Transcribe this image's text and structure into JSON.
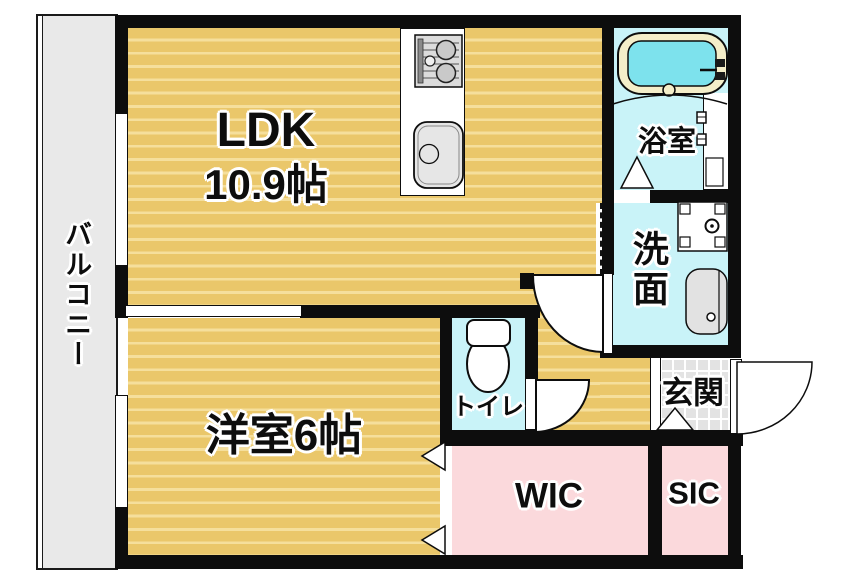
{
  "plan_type": "apartment-floorplan",
  "rooms": {
    "balcony": {
      "label": "バルコニー"
    },
    "ldk": {
      "label": "LDK",
      "area": "10.9帖"
    },
    "western_room": {
      "label": "洋室6帖"
    },
    "bathroom": {
      "label": "浴室"
    },
    "washroom": {
      "label": "洗面"
    },
    "toilet": {
      "label": "トイレ"
    },
    "entrance": {
      "label": "玄関"
    },
    "wic": {
      "label": "WIC"
    },
    "sic": {
      "label": "SIC"
    }
  },
  "colors": {
    "wall": "#0d0d0d",
    "flooring": "#eac76a",
    "flooring_stripe": "#f5df9c",
    "wet_room_floor": "#c9f3f8",
    "closet_pink": "#fbd9dc",
    "balcony_gray": "#e9e9e9",
    "entrance_tile": "#e3e3e3",
    "bathtub_water": "#7de2ed",
    "bathtub_rim": "#f4eec9"
  },
  "icons": {
    "bathtub": "bathtub-icon",
    "gas_stove": "gas-stove-icon",
    "kitchen_sink": "kitchen-sink-icon",
    "washing_machine_pan": "washing-machine-pan-icon",
    "vanity_basin": "vanity-basin-icon",
    "toilet_bowl": "toilet-bowl-icon",
    "door_swing": "door-swing-arc",
    "folding_door": "folding-door-triangle",
    "sliding_window": "window-strip",
    "entrance_step": "entrance-step-triangle"
  }
}
